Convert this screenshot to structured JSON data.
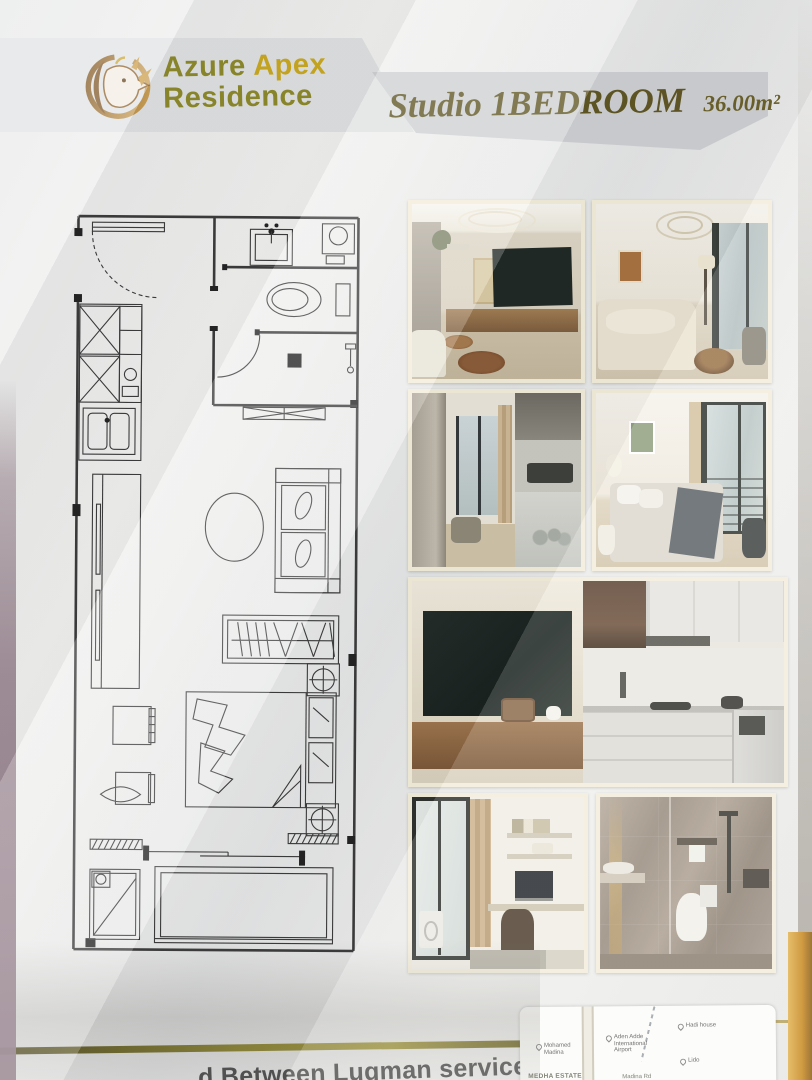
{
  "header": {
    "brand": {
      "logo_icon": "rhino-circle-logo",
      "name_line1_a": "Azure",
      "name_line1_b": "Apex",
      "name_line2": "Residence"
    },
    "unit_title": "Studio 1BEDROOM",
    "unit_area": "36.00m²"
  },
  "floor_plan": {
    "name": "studio-unit-floor-plan",
    "rooms_depicted": [
      "entry",
      "bathroom",
      "kitchen",
      "living-area",
      "bed-area",
      "balcony"
    ]
  },
  "gallery": {
    "photos": [
      {
        "name": "living-room-tv-wall"
      },
      {
        "name": "living-room-sofa"
      },
      {
        "name": "kitchen-hallway"
      },
      {
        "name": "bedroom-balcony"
      },
      {
        "name": "tv-console-and-kitchen"
      },
      {
        "name": "workspace-balcony-laundry"
      },
      {
        "name": "bathroom"
      }
    ]
  },
  "footer": {
    "caption_fragment": "d Between Luqman service",
    "map": {
      "pins": [
        {
          "label": "Mohamed Madina"
        },
        {
          "label": "Aden Adde International Airport"
        },
        {
          "label": "Hadi house"
        },
        {
          "label": "Lido"
        }
      ],
      "area_label": "MEDHA ESTATE",
      "road_label": "Madina Rd"
    }
  },
  "colors": {
    "brand_olive": "#8c8828",
    "brand_gold": "#c9a81d",
    "title_bronze": "#5e5422",
    "band_gray": "#cdcfd1",
    "photo_frame_cream": "#f2ecda",
    "gold_rule": "#8d852f",
    "edge_orange": "#c5861d"
  }
}
